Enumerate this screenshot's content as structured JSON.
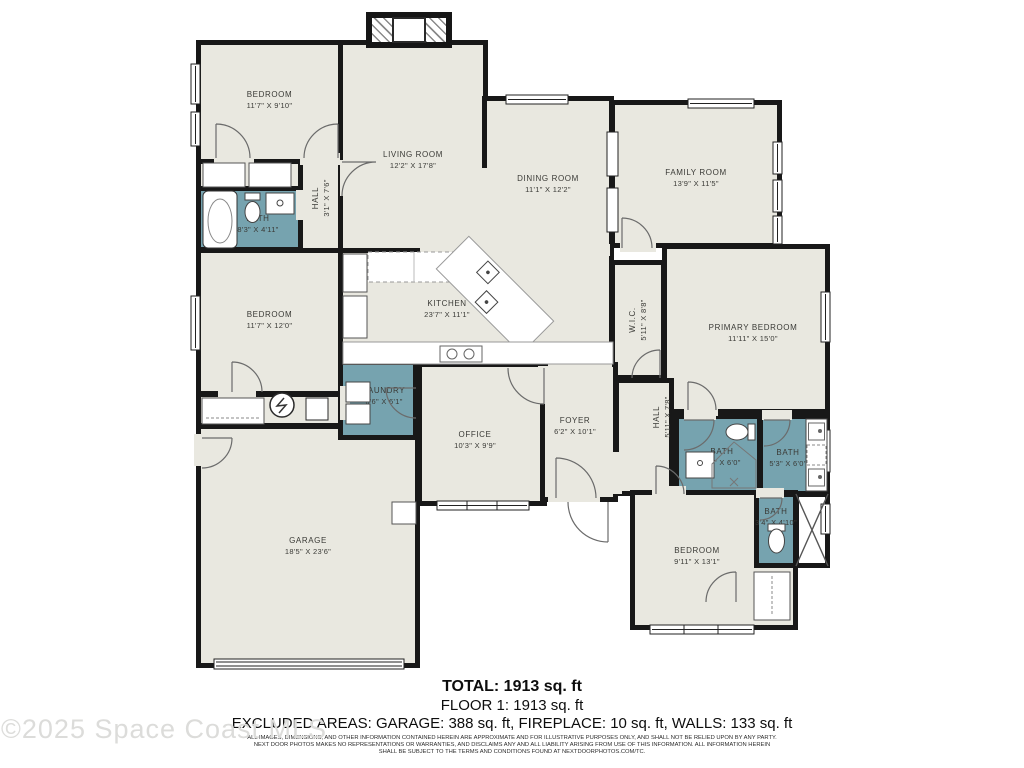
{
  "plan": {
    "colors": {
      "wall": "#181818",
      "floor": "#e9e8e0",
      "wet": "#76a3af",
      "background": "#ffffff"
    },
    "rooms": [
      {
        "id": "closet-row-1",
        "kind": "room",
        "x": 196,
        "y": 158,
        "w": 108,
        "h": 34
      },
      {
        "id": "bath-top-left",
        "kind": "wet",
        "x": 196,
        "y": 186,
        "w": 108,
        "h": 66,
        "label": "BATH",
        "dims": "8'3\" X 4'11\"",
        "dx": 8,
        "dy": 5
      },
      {
        "id": "hall-top-left",
        "kind": "room",
        "x": 298,
        "y": 158,
        "w": 46,
        "h": 96,
        "label": "HALL",
        "dims": "3'1\" X 7'6\"",
        "vertical": true,
        "dy": -8
      },
      {
        "id": "bedroom-1",
        "kind": "room",
        "x": 196,
        "y": 40,
        "w": 147,
        "h": 124,
        "label": "BEDROOM",
        "dims": "11'7\" X 9'10\"",
        "dy": -2
      },
      {
        "id": "living-room",
        "kind": "room",
        "x": 338,
        "y": 40,
        "w": 150,
        "h": 216,
        "label": "LIVING ROOM",
        "dims": "12'2\" X 17'8\"",
        "dy": 12
      },
      {
        "id": "dining-room",
        "kind": "room",
        "x": 482,
        "y": 96,
        "w": 132,
        "h": 160,
        "label": "DINING ROOM",
        "dims": "11'1\" X 12'2\"",
        "dy": 8
      },
      {
        "id": "family-room",
        "kind": "room",
        "x": 610,
        "y": 100,
        "w": 172,
        "h": 148,
        "label": "FAMILY ROOM",
        "dims": "13'9\" X 11'5\"",
        "dy": 4
      },
      {
        "id": "kitchen",
        "kind": "room",
        "x": 338,
        "y": 248,
        "w": 276,
        "h": 118,
        "label": "KITCHEN",
        "dims": "23'7\" X 11'1\"",
        "dx": -29,
        "dy": 2
      },
      {
        "id": "wic",
        "kind": "room",
        "x": 610,
        "y": 260,
        "w": 56,
        "h": 120,
        "label": "W.I.C.",
        "dims": "5'11\" X 8'8\"",
        "vertical": true
      },
      {
        "id": "primary-bedroom",
        "kind": "room",
        "x": 662,
        "y": 244,
        "w": 168,
        "h": 170,
        "label": "PRIMARY BEDROOM",
        "dims": "11'11\" X 15'0\"",
        "dx": 7,
        "dy": 4
      },
      {
        "id": "bedroom-2",
        "kind": "room",
        "x": 196,
        "y": 248,
        "w": 147,
        "h": 148,
        "label": "BEDROOM",
        "dims": "11'7\" X 12'0\"",
        "dy": -2
      },
      {
        "id": "utility-nook",
        "kind": "room",
        "x": 196,
        "y": 392,
        "w": 148,
        "h": 36
      },
      {
        "id": "garage",
        "kind": "room",
        "x": 196,
        "y": 424,
        "w": 224,
        "h": 244,
        "label": "GARAGE",
        "dims": "18'5\" X 23'6\"",
        "dy": 0
      },
      {
        "id": "laundry",
        "kind": "wet",
        "x": 338,
        "y": 360,
        "w": 80,
        "h": 80,
        "label": "LAUNDRY",
        "dims": "6'6\" X 6'1\"",
        "dx": 6,
        "dy": -4
      },
      {
        "id": "office",
        "kind": "room",
        "x": 417,
        "y": 362,
        "w": 130,
        "h": 144,
        "label": "OFFICE",
        "dims": "10'3\" X 9'9\"",
        "dx": -7,
        "dy": 6
      },
      {
        "id": "foyer",
        "kind": "room",
        "x": 540,
        "y": 362,
        "w": 78,
        "h": 140,
        "label": "FOYER",
        "dims": "6'2\" X 10'1\"",
        "dx": -4,
        "dy": -6
      },
      {
        "id": "hall-right",
        "kind": "room",
        "x": 614,
        "y": 378,
        "w": 60,
        "h": 118,
        "label": "HALL",
        "dims": "5'11\" X 7'8\"",
        "vertical": true,
        "dx": 18,
        "dy": -20
      },
      {
        "id": "bath-middle",
        "kind": "wet",
        "x": 674,
        "y": 414,
        "w": 88,
        "h": 82,
        "label": "BATH",
        "dims": "6'4\" X 6'0\"",
        "dx": 4,
        "dy": 2
      },
      {
        "id": "bath-right",
        "kind": "wet",
        "x": 758,
        "y": 414,
        "w": 72,
        "h": 82,
        "label": "BATH",
        "dims": "5'3\" X 6'0\"",
        "dx": -6,
        "dy": 3
      },
      {
        "id": "bedroom-3",
        "kind": "room",
        "x": 630,
        "y": 490,
        "w": 168,
        "h": 140,
        "label": "BEDROOM",
        "dims": "9'11\" X 13'1\"",
        "dx": -17,
        "dy": -4
      },
      {
        "id": "bath-bottom",
        "kind": "wet",
        "x": 754,
        "y": 492,
        "w": 44,
        "h": 76,
        "label": "BATH",
        "dims": "3'4\" X 4'10\"",
        "dy": -13
      },
      {
        "id": "shower-bottom",
        "kind": "shower",
        "x": 794,
        "y": 492,
        "w": 36,
        "h": 76
      }
    ]
  },
  "footer": {
    "total": "TOTAL: 1913 sq. ft",
    "floor": "FLOOR 1: 1913 sq. ft",
    "excluded": "EXCLUDED AREAS: GARAGE: 388 sq. ft, FIREPLACE: 10 sq. ft, WALLS: 133 sq. ft",
    "disclaimer_1": "ALL IMAGES, DIMENSIONS, AND OTHER INFORMATION CONTAINED HEREIN ARE APPROXIMATE AND FOR ILLUSTRATIVE PURPOSES ONLY, AND SHALL NOT BE RELIED UPON BY ANY PARTY.",
    "disclaimer_2": "NEXT DOOR PHOTOS MAKES NO REPRESENTATIONS OR WARRANTIES, AND DISCLAIMS ANY AND ALL LIABILITY ARISING FROM USE OF THIS INFORMATION. ALL INFORMATION HEREIN",
    "disclaimer_3": "SHALL BE SUBJECT TO THE TERMS AND CONDITIONS FOUND AT NEXTDOORPHOTOS.COM/TC."
  },
  "watermark": "©2025 Space Coast MLS"
}
